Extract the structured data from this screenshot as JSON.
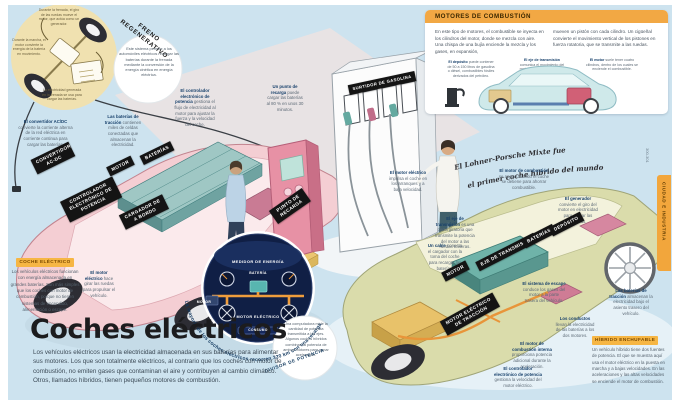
{
  "page": {
    "title": "Coches eléctricos",
    "intro": "Los vehículos eléctricos usan la electricidad almacenada en sus baterías para alimentar sus motores. Los que son totalmente eléctricos, al contrario que los coches con motor de combustión, no emiten gases que contaminan el aire y contribuyen al cambio climático. Otros, llamados híbridos, tienen pequeños motores de combustión.",
    "section_tab": "CIUDAD E INDUSTRIA",
    "page_numbers": "300-301"
  },
  "regen": {
    "title": "FRENO REGENERATIVO",
    "desc": "Este sistema permite a los automóviles eléctricos recargar las baterías durante la frenada mediante la conversión de la energía cinética en energía eléctrica.",
    "note_top": "Durante la frenada, el giro de las ruedas mueve el motor, que actúa como un generador.",
    "note_left": "Durante la marcha, el motor convierte la energía de la batería en movimiento.",
    "note_bottom": "La electricidad generada en la frenada se usa para cargar las baterías."
  },
  "combustion": {
    "title": "MOTORES DE COMBUSTIÓN",
    "col1": "En este tipo de motores, el combustible se inyecta en los cilindros del motor, donde se mezcla con aire. Una chispa de una bujía enciende la mezcla y los gases, en expansión,",
    "col2": "mueven un pistón con cada cilindro. Un cigüeñal convierte el movimiento vertical de los pistones en fuerza rotatoria, que se transmite a las ruedas.",
    "captions": [
      {
        "lead": "El depósito",
        "text": "puede contener de 50 a 150 litros de gasolina o diésel, combustibles fósiles derivados del petróleo."
      },
      {
        "lead": "El eje de transmisión",
        "text": "comunica el movimiento del motor a las ruedas traseras."
      },
      {
        "lead": "El motor",
        "text": "suele tener cuatro cilindros, dentro de los cuales se enciende el combustible."
      }
    ]
  },
  "quote_lohner": {
    "line1": "El Lohner-Porsche Mixte fue",
    "line2": "el primer coche híbrido del mundo"
  },
  "electric": {
    "info": {
      "title": "COCHE ELÉCTRICO",
      "text": "Los vehículos eléctricos funcionan con energía almacenada en grandes baterías. Son más simples que los coches con motor de combustión, porque no tienen sistemas de encendido, alimentación o escape."
    },
    "labels": [
      "CONVERTIDOR AC-DC",
      "BATERÍAS",
      "MOTOR",
      "CONTROLADOR ELECTRÓNICO DE POTENCIA",
      "CARGADOR DE A BORDO",
      "PUNTO DE RECARGA",
      "SURTIDOR DE GASOLINA"
    ],
    "ann": [
      {
        "lead": "El convertidor AC/DC",
        "text": "convierte la corriente alterna de la red eléctrica en corriente continua para cargar las baterías."
      },
      {
        "lead": "Las baterías de tracción",
        "text": "contienen miles de celdas conectadas que almacenan la electricidad."
      },
      {
        "lead": "El controlador electrónico de potencia",
        "text": "gestiona el flujo de electricidad al motor para ajustar la fuerza y la velocidad del coche."
      },
      {
        "lead": "Un punto de recarga",
        "text": "puede cargar las baterías al 80 % en unos 30 minutos."
      },
      {
        "lead": "El motor eléctrico",
        "text": "hace girar las ruedas para propulsar el vehículo."
      }
    ]
  },
  "dashboard": {
    "title": "MEDIDOR DE ENERGÍA",
    "battery": "BATERÍA",
    "motor": "MOTOR",
    "motor_electric": "MOTOR ELÉCTRICO",
    "consumption": "CONSUMO",
    "range_quote": "La mayoría de los coches eléctricos recorren 320 km con una recarga"
  },
  "power_split": {
    "title": "DIVISOR DE POTENCIA",
    "text": "Una computadora mide la cantidad de potencia transmitida a los ejes. Algunos coches híbridos combinan la potencia de ambos motores para ganar aceleración."
  },
  "hybrid": {
    "info": {
      "title": "HÍBRIDO ENCHUFABLE",
      "text": "Un vehículo híbrido tiene dos fuentes de potencia. El que se muestra aquí usa el motor eléctrico en la puesta en marcha y a bajas velocidades. En las aceleraciones y las altas velocidades se enciende el motor de combustión."
    },
    "labels": [
      "MOTOR",
      "EJE DE TRANSMISIÓN",
      "BATERÍAS",
      "DEPÓSITO",
      "MOTOR ELÉCTRICO DE TRACCIÓN"
    ],
    "ann": [
      {
        "lead": "El motor eléctrico",
        "text": "impulsa el coche en los arranques y a baja velocidad."
      },
      {
        "lead": "El motor de combustión",
        "text": "se apaga cuando el coche se detiene para ahorrar combustible."
      },
      {
        "lead": "El generador",
        "text": "convierte el giro del motor en electricidad para cargar las baterías."
      },
      {
        "lead": "El eje de transmisión",
        "text": "es una pieza giratoria que transmite la potencia del motor a las ruedas traseras."
      },
      {
        "lead": "Un cable",
        "text": "conecta el cargador con la toma del coche para recargar las baterías."
      },
      {
        "lead": "El sistema de escape",
        "text": "conduce los gases del motor a la parte trasera del vehículo."
      },
      {
        "lead": "Los conductos",
        "text": "llevan la electricidad de las baterías a los dos motores."
      },
      {
        "lead": "El motor de combustión interna",
        "text": "proporciona potencia adicional durante la aceleración."
      },
      {
        "lead": "El controlador electrónico de potencia",
        "text": "gestiona la velocidad del motor eléctrico."
      },
      {
        "lead": "Las baterías de tracción",
        "text": "almacenan la electricidad bajo el asiento trasero del vehículo."
      }
    ]
  }
}
